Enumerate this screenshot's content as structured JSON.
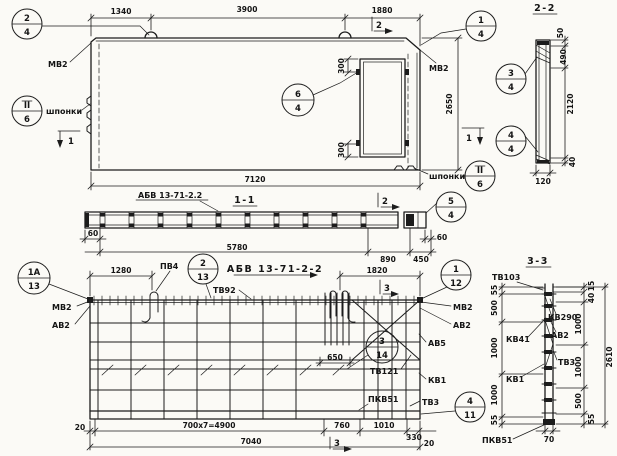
{
  "drawing_type": "precast concrete wall panel working drawing",
  "elevation": {
    "dims": {
      "w1": "1340",
      "w2": "3900",
      "w3": "1880",
      "h": "2650",
      "total_w": "7120",
      "door_top": "300",
      "door_bottom": "300"
    },
    "labels": {
      "mv2_left": "МВ2",
      "mv2_right": "МВ2",
      "keys_left": "шпонки",
      "keys_right": "шпонки"
    },
    "markers": {
      "cut1_left": "1",
      "cut1_right": "1",
      "cut2_top": "2"
    }
  },
  "section_2_2": {
    "title": "2-2",
    "dims": {
      "d50": "50",
      "d490": "490",
      "d2120": "2120",
      "d40": "40",
      "d120": "120"
    }
  },
  "section_1_1": {
    "title": "1-1",
    "slab_mark": "АБВ 13-71-2.2",
    "dims": {
      "d60_left": "60",
      "d5780": "5780",
      "d890": "890",
      "d450": "450",
      "d60_right": "60"
    },
    "markers": {
      "cut2": "2"
    }
  },
  "plan": {
    "title": "АБВ 13-71-2-2",
    "dims": {
      "d1280": "1280",
      "d1820": "1820",
      "d650": "650",
      "d20_left": "20",
      "d700x7": "700x7=4900",
      "d760": "760",
      "d1010": "1010",
      "d330": "330",
      "d20_right": "20",
      "d7040": "7040"
    },
    "labels": {
      "pv4": "ПВ4",
      "tv92": "ТВ92",
      "tv121": "ТВ121",
      "mv2_left": "МВ2",
      "av2_left": "АВ2",
      "mv2_right": "МВ2",
      "av2_right": "АВ2",
      "av5": "АВ5",
      "kv1": "КВ1",
      "pkv51": "ПКВ51",
      "tv3": "ТВ3"
    },
    "markers": {
      "cut3_top": "3",
      "cut3_bottom": "3"
    }
  },
  "section_3_3": {
    "title": "3-3",
    "labels": {
      "tv103": "ТВ103",
      "kv290": "КВ290",
      "av2": "АВ2",
      "kv41": "КВ41",
      "tv3": "ТВ3",
      "kv1": "КВ1",
      "pkv51": "ПКВ51"
    },
    "dims": {
      "left_55_top": "55",
      "left_500": "500",
      "left_1000_a": "1000",
      "left_1000_b": "1000",
      "left_55_bottom": "55",
      "right_15": "15",
      "right_40": "40",
      "right_1000_a": "1000",
      "right_1000_b": "1000",
      "right_500": "500",
      "right_55": "55",
      "total": "2610",
      "d70": "70"
    }
  },
  "callouts": {
    "c2_4": {
      "num": "2",
      "sheet": "4"
    },
    "c1_4": {
      "num": "1",
      "sheet": "4"
    },
    "c6_4": {
      "num": "6",
      "sheet": "4"
    },
    "cII_6_left": {
      "num": "II",
      "sheet": "6"
    },
    "cII_6_right": {
      "num": "II",
      "sheet": "6"
    },
    "c3_4": {
      "num": "3",
      "sheet": "4"
    },
    "c4_4": {
      "num": "4",
      "sheet": "4"
    },
    "c5_4": {
      "num": "5",
      "sheet": "4"
    },
    "c1a_13": {
      "num": "1А",
      "sheet": "13"
    },
    "c2_13": {
      "num": "2",
      "sheet": "13"
    },
    "c3_14": {
      "num": "3",
      "sheet": "14"
    },
    "c1_12": {
      "num": "1",
      "sheet": "12"
    },
    "c4_11": {
      "num": "4",
      "sheet": "11"
    }
  }
}
